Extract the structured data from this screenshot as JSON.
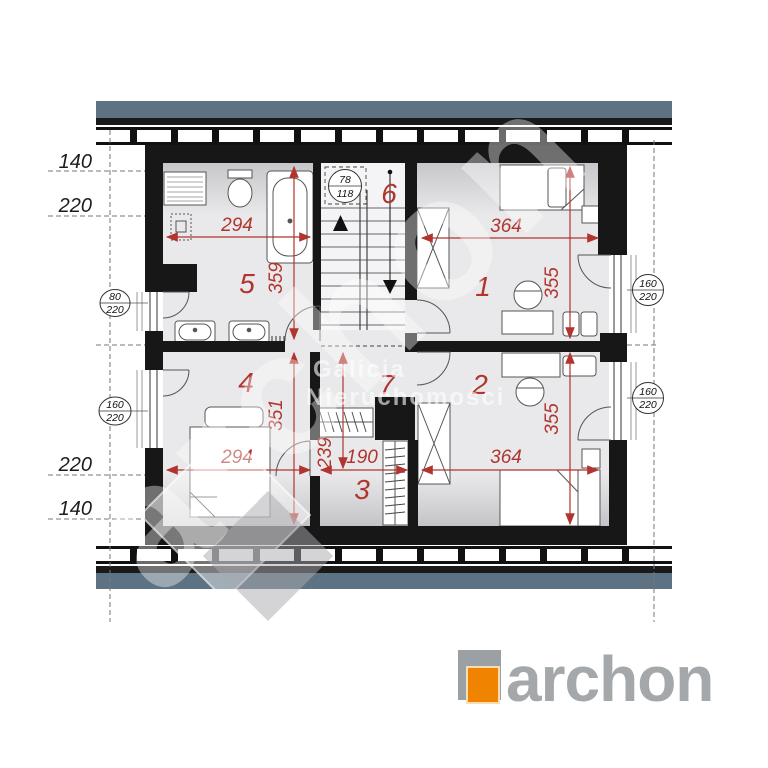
{
  "plan": {
    "room_numbers": [
      "1",
      "2",
      "3",
      "4",
      "5",
      "6",
      "7"
    ],
    "dims": {
      "bath_w": "294",
      "bath_h": "359",
      "r1_w": "364",
      "r1_h": "355",
      "r4_w": "294",
      "r4_h": "351",
      "hall_h": "239",
      "r3_w": "190",
      "r2_w": "364",
      "r2_h": "355"
    },
    "height_labels": {
      "top_140": "140",
      "top_220": "220",
      "bot_220": "220",
      "bot_140": "140"
    },
    "callouts": {
      "left_top": {
        "num": "80",
        "den": "220"
      },
      "left_bottom": {
        "num": "160",
        "den": "220"
      },
      "right_top": {
        "num": "160",
        "den": "220"
      },
      "right_bottom": {
        "num": "160",
        "den": "220"
      },
      "skylight": {
        "num": "78",
        "den": "118"
      }
    }
  },
  "watermarks": {
    "brand": "archon",
    "agency_line1": "Galicja",
    "agency_line2": "Nieruchomości"
  },
  "logo": {
    "brand": "archon"
  },
  "colors": {
    "dim_red": "#b1352e",
    "band_blue": "#5d7384",
    "wall": "#171717",
    "logo_orange": "#f08300",
    "logo_square_gray": "#9aa0a4",
    "logo_text_gray": "#a4a8ab"
  }
}
